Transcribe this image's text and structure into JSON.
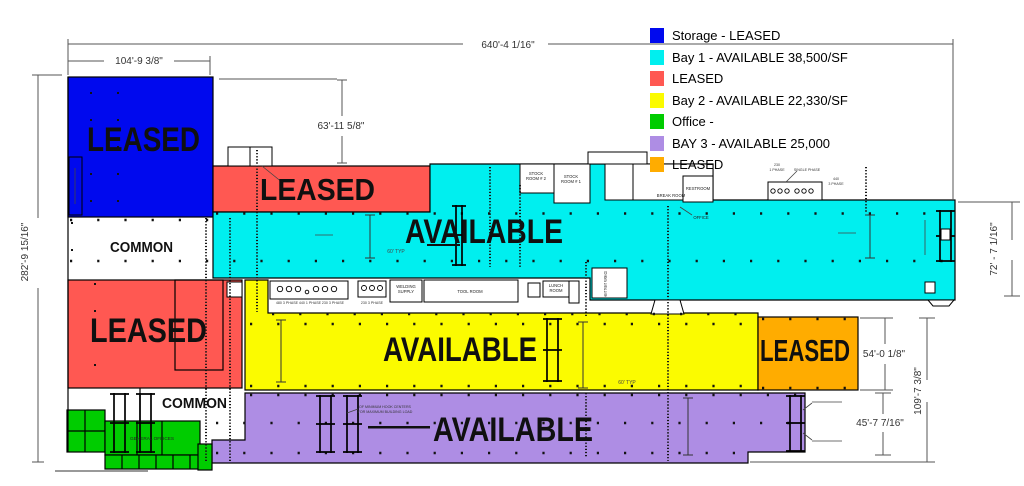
{
  "colors": {
    "storage": "#0009EE",
    "bay1": "#00EFEF",
    "leased_red": "#FF5852",
    "bay2": "#FBFB00",
    "office": "#00CC00",
    "bay3": "#AE8DE4",
    "leased_orange": "#FFAC00"
  },
  "legend": {
    "items": [
      {
        "label": "Storage - LEASED"
      },
      {
        "label": "Bay 1 - AVAILABLE 38,500/SF"
      },
      {
        "label": "LEASED"
      },
      {
        "label": "Bay 2 - AVAILABLE  22,330/SF"
      },
      {
        "label": "Office -"
      },
      {
        "label": "BAY 3 - AVAILABLE 25,000"
      },
      {
        "label": "LEASED"
      }
    ]
  },
  "regions": {
    "storage": "LEASED",
    "red_upper": "LEASED",
    "bay1": "AVAILABLE",
    "red_lower": "LEASED",
    "bay2": "AVAILABLE",
    "orange": "LEASED",
    "bay3": "AVAILABLE",
    "common_upper": "COMMON",
    "common_lower": "COMMON"
  },
  "dimensions": {
    "overall_width": "640'-4 1/16\"",
    "storage_width": "104'-9 3/8\"",
    "north_offset": "63'-11 5/8\"",
    "overall_depth": "282'-9 15/16\"",
    "bay1_depth": "72' - 7 1/16\"",
    "orange_depth": "54'-0 1/8\"",
    "bay3_depth": "45'-7 7/16\"",
    "south_depth": "109'-7 3/8\""
  },
  "rooms": {
    "stock2_line1": "STOCK",
    "stock2_line2": "ROOM # 2",
    "stock1_line1": "STOCK",
    "stock1_line2": "ROOM # 1",
    "restroom": "RESTROOM",
    "break_room": "BREAK ROOM",
    "office": "OFFICE",
    "welding_line1": "WELDING",
    "welding_line2": "SUPPLY",
    "tool_room": "TOOL ROOM",
    "lunch_line1": "LUNCH",
    "lunch_line2": "ROOM",
    "general_offices": "GENERAL OFFICES",
    "heat_treat": "HEAT TREAT FURNACE"
  },
  "annotations": {
    "elec_230": "230",
    "elec_230_phase": "1 PHASE",
    "elec_single": "SINGLE PHASE",
    "elec_440": "440",
    "elec_440_phase": "3 PHASE",
    "panel_480": "480 3 PHASE",
    "panel_440": "440 1 PHASE",
    "panel_230a": "230 3 PHASE",
    "panel_230b": "230 3 PHASE",
    "typ_bay1": "60' TYP",
    "typ_bay2": "60' TYP",
    "crane_note_line1": "OF MINIMUM HOOK CENTERS",
    "crane_note_line2": "FOR MAXIMUM BUILDING LOAD"
  }
}
